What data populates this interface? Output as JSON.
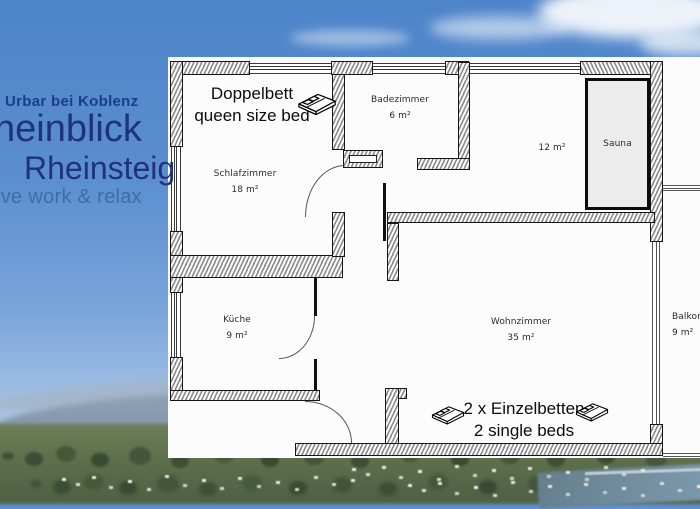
{
  "overlay": {
    "location": "Urbar bei Koblenz",
    "title": "heinblick",
    "subtitle": "Rheinsteig",
    "tagline": "ive work & relax",
    "colors": {
      "title": "#20317e",
      "tagline": "#3e6cab"
    }
  },
  "floorplan": {
    "rooms": [
      {
        "name": "Schlafzimmer",
        "area": "18 m²"
      },
      {
        "name": "Badezimmer",
        "area": "6 m²"
      },
      {
        "name": "",
        "area": "12 m²"
      },
      {
        "name": "Sauna",
        "area": ""
      },
      {
        "name": "Küche",
        "area": "9 m²"
      },
      {
        "name": "Wohnzimmer",
        "area": "35 m²"
      },
      {
        "name": "Balkon",
        "area": "9 m²"
      }
    ],
    "annotations": [
      {
        "line1": "Doppelbett",
        "line2": "queen size bed",
        "icon": "double-bed-icon"
      },
      {
        "line1": "2 x Einzelbetten",
        "line2": "2 single beds",
        "icon": "single-bed-icon"
      }
    ]
  }
}
